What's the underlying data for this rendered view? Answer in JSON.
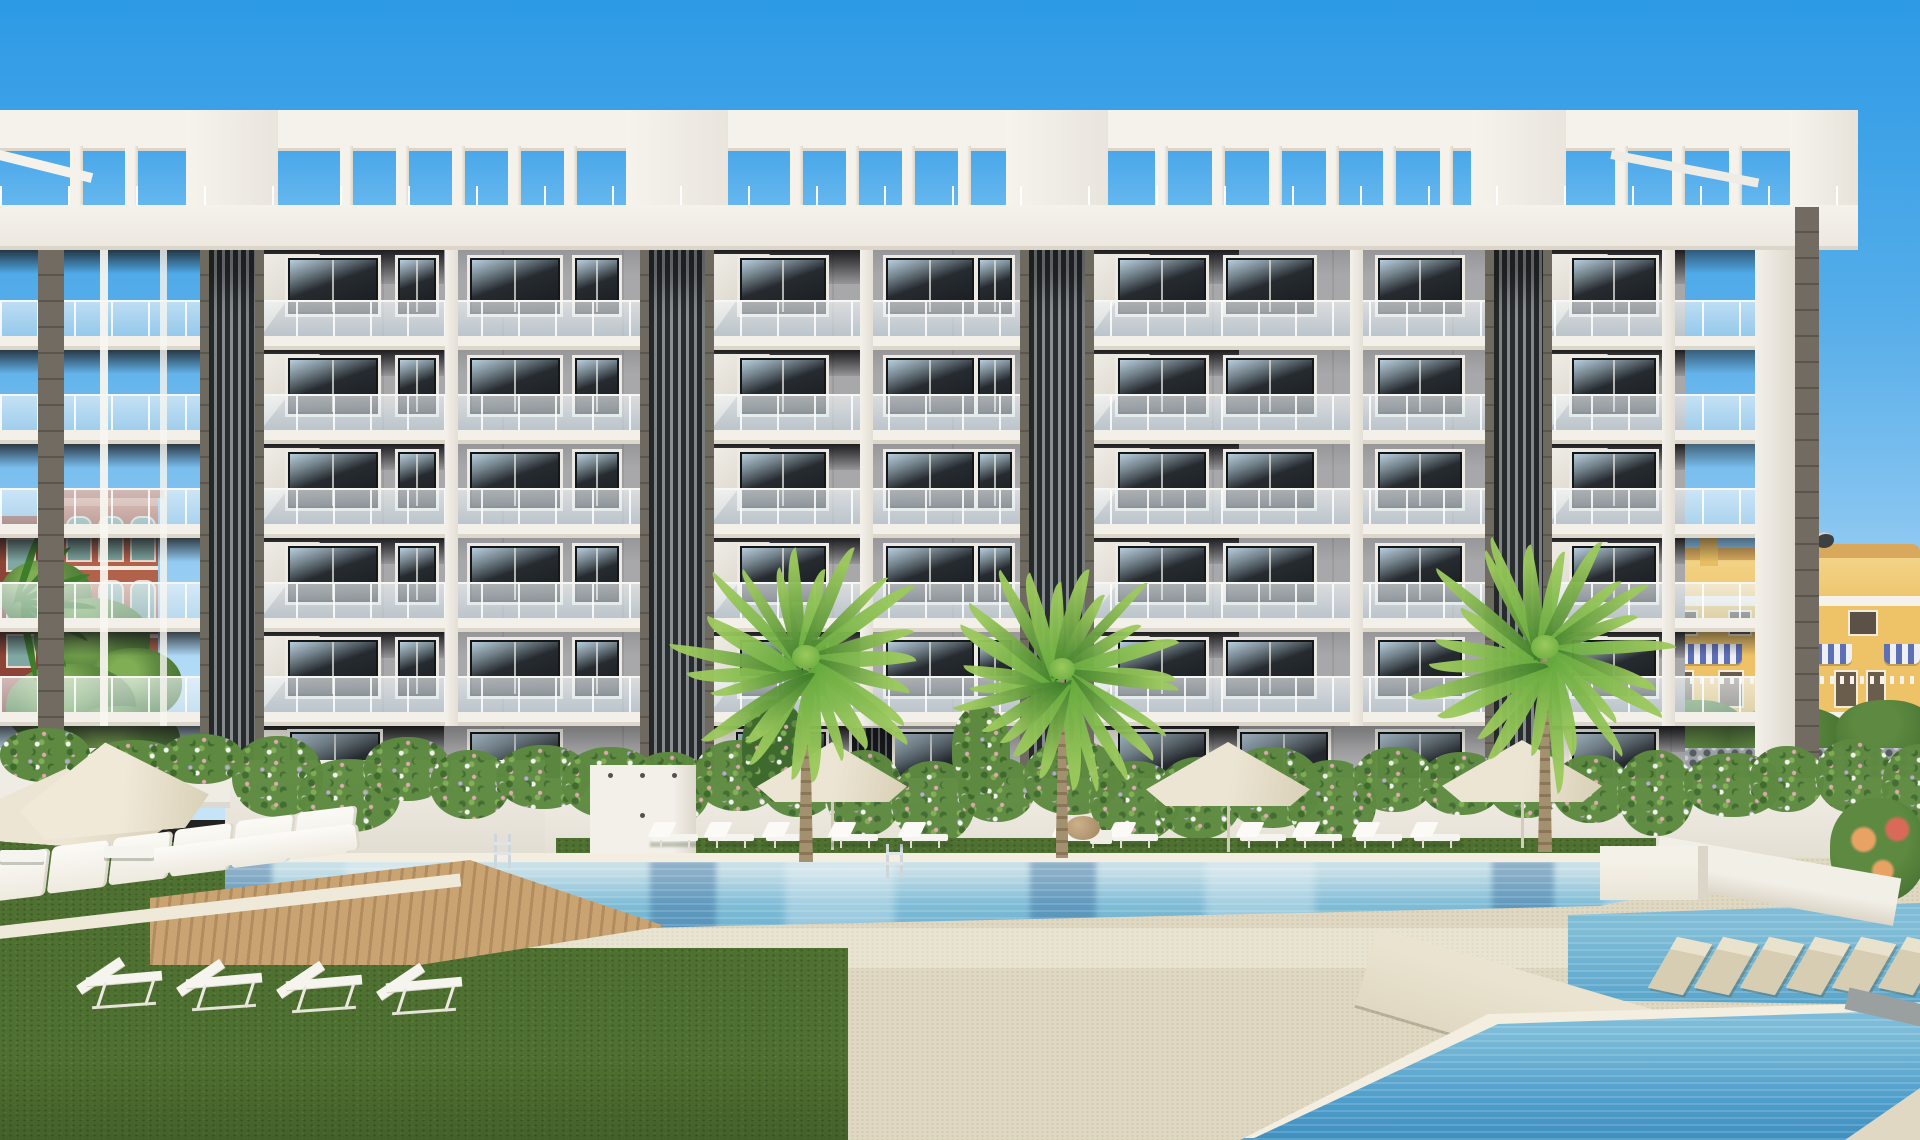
{
  "scene": {
    "description": "Architectural render of a modern six-storey white apartment complex with dark slatted pillar towers, rooftop pergola, flowering hedges, three palm trees, sun loungers, parasols and a large turquoise swimming pool with stepping stones and a lower infinity pool.",
    "counts": {
      "floors": 6,
      "intermediate_slabs": 5,
      "dark_towers": 4,
      "front_palms": 3,
      "palm_fronds_per_palm": 24,
      "poolside_umbrellas": 3,
      "left_corner_umbrellas": 2,
      "poolside_loungers": 11,
      "lawn_loungers": 4,
      "daybed_cushions": 6,
      "stepping_stones": 6,
      "pools": 3,
      "pool_ladders": 2,
      "hedge_blobs": 26
    }
  },
  "colors": {
    "sky_top": "#2d9ae6",
    "sky_mid": "#55ade9",
    "sky_low": "#83c3f0",
    "sky_horizon": "#c6e4f7",
    "white_hi": "#f5f2ec",
    "white": "#efece5",
    "white_shade": "#dcd6ca",
    "wall": "#a8a8aa",
    "wall_dark": "#8f8f92",
    "soffit": "#2f2f32",
    "tower_edge": "#6f6a60",
    "tower_dark": "#2c2f31",
    "tower_slat": "#8e9496",
    "pillar_brown": "#716b62",
    "glass": "rgba(203,223,234,0.50)",
    "window_deep": "#171b1f",
    "frame": "#14171a",
    "paving": "#e0d8c2",
    "paving_light": "#eae3cf",
    "grass": "#4e7030",
    "grass_dark": "#405f28",
    "pool_pale": "#c8e0e8",
    "pool": "#7fbcd6",
    "pool_deep": "#58a4cb",
    "pool_reflect": "rgba(47,98,150,0.38)",
    "coping": "#f3eee0",
    "wood": "#c9a372",
    "hedge": "#5d8a40",
    "hedge_dark": "#3f6a2e",
    "hedge_light": "#7fae54",
    "flower_pink": "#e3a8b4",
    "flower_white": "#f2f2ef",
    "flower_purple": "#b9a8d6",
    "umbrella": "#ece5d3",
    "umbrella_shade": "#d8cfb5",
    "lounger": "#f6f4ee",
    "house_yellow": "#eec267",
    "house_roof": "#d8a95c",
    "awning_blue": "#5d6fb5",
    "terra": "#b2614a",
    "terra_dark": "#8c4436",
    "teal_glass": "#7fa8a2",
    "palm_green": "#63a83c",
    "palm_dark": "#3e7d2a",
    "palm_light": "#9cc95d",
    "trunk": "#a3906f",
    "trunk_dark": "#8a7557"
  }
}
